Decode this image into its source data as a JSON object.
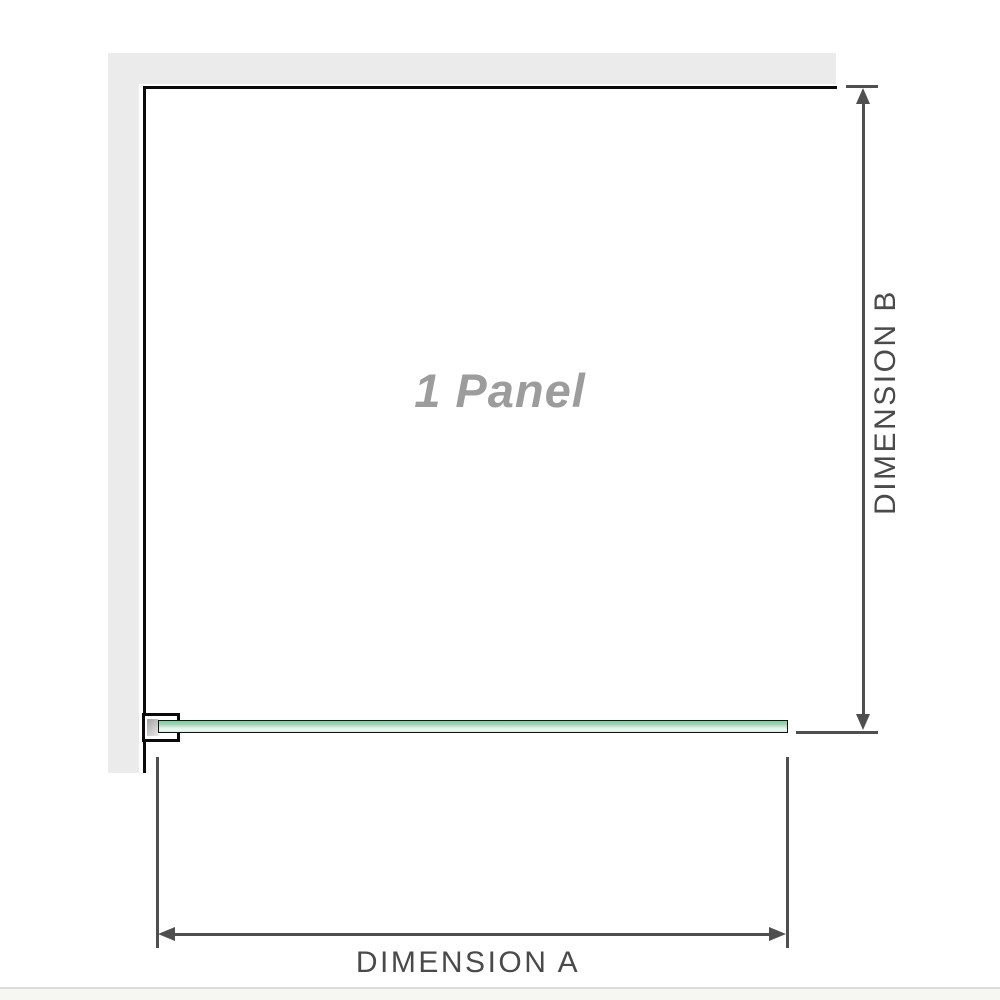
{
  "diagram": {
    "panel_label": "1 Panel",
    "dimensions": {
      "a_label": "DIMENSION A",
      "b_label": "DIMENSION B"
    },
    "colors": {
      "wall": "#ebebeb",
      "wall_edge": "#0a0a0a",
      "dim_line": "#4f4f4f",
      "dim_text": "#4a4a4a",
      "panel_text": "#9c9c9c",
      "glass_border": "#141414",
      "glass_green": "#86cba1",
      "glass_green_light": "#f0f9f4",
      "bracket_fill": "#ffffff",
      "bracket_inner": "#a0a0a0",
      "divider": "#dcdcdc"
    }
  }
}
